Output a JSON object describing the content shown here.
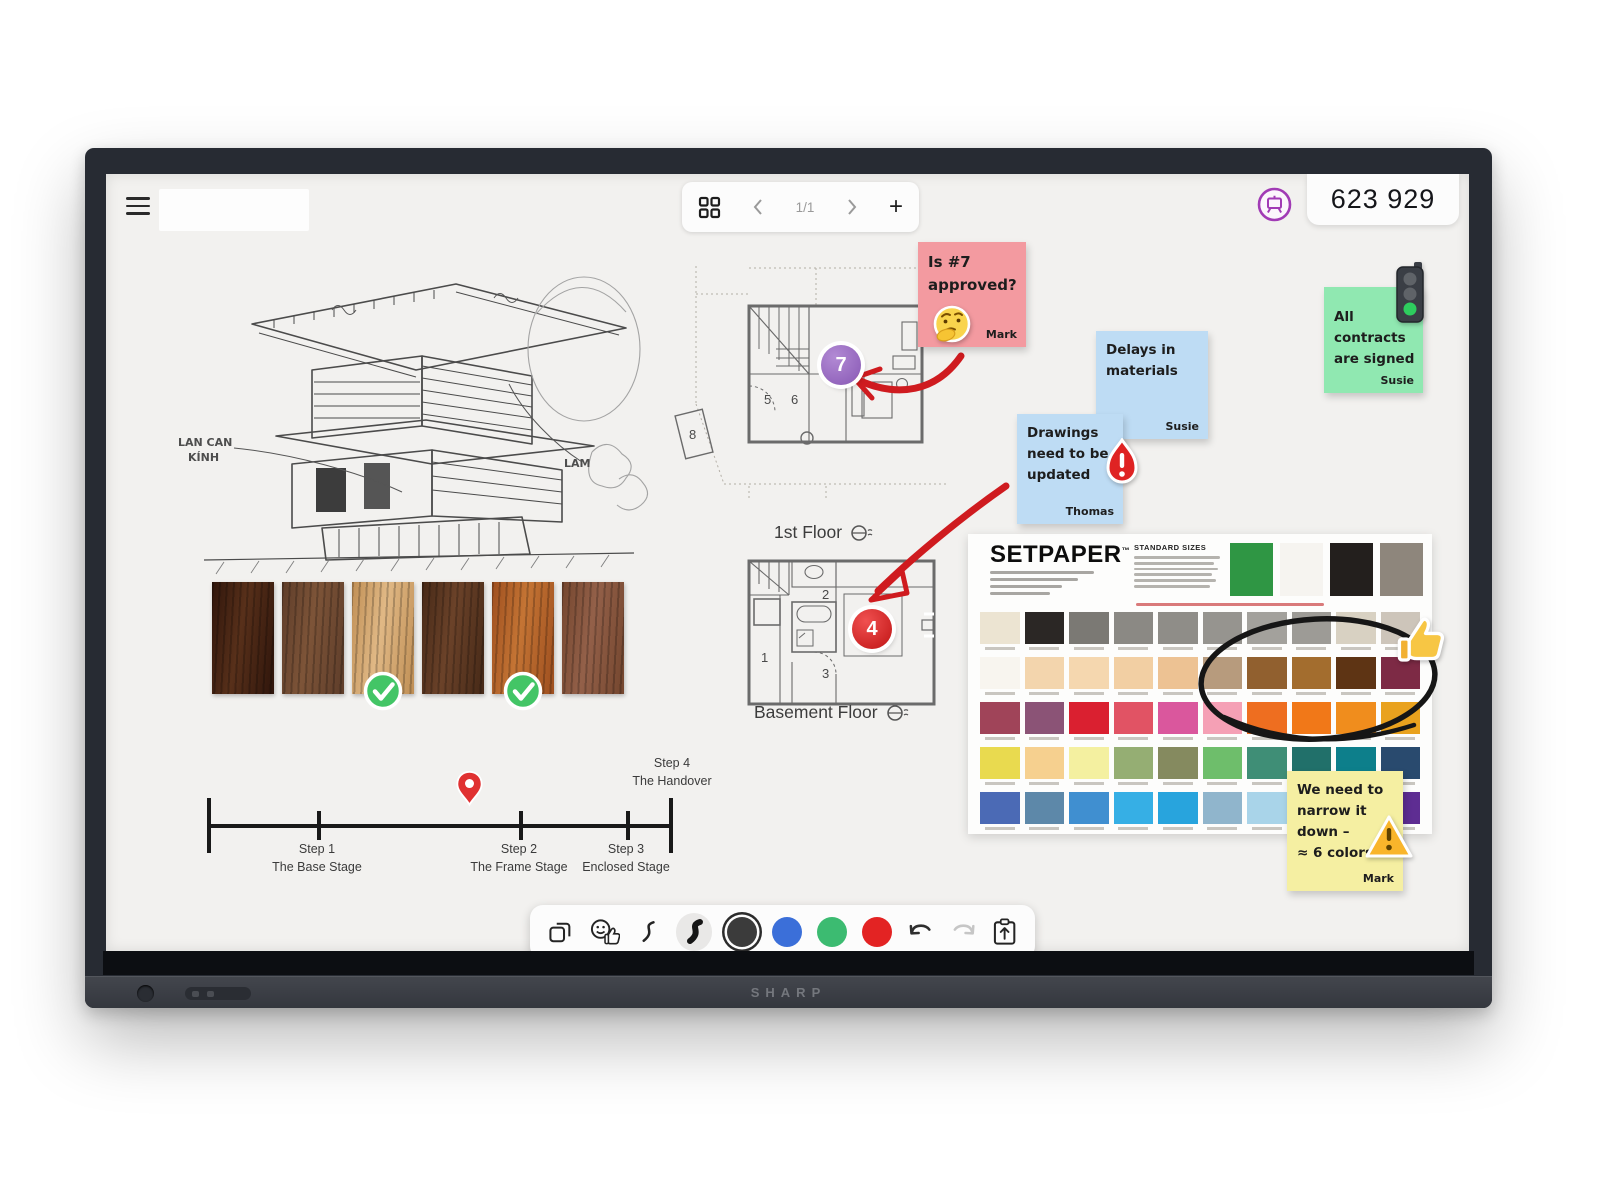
{
  "device": {
    "brand": "SHARP"
  },
  "topbar": {
    "page_indicator": "1/1",
    "session_code": "623 929"
  },
  "sketch": {
    "annotations": [
      "LAN CAN",
      "KÍNH",
      "LAM"
    ]
  },
  "plans": {
    "first_floor": {
      "label": "1st Floor",
      "rooms": [
        "5",
        "6",
        "8"
      ],
      "marker": "7",
      "marker_color": "#9b6ec4"
    },
    "basement": {
      "label": "Basement Floor",
      "rooms": [
        "1",
        "2",
        "3"
      ],
      "marker": "4",
      "marker_color": "#d81f26"
    }
  },
  "stickies": {
    "pink": {
      "lines": [
        "Is #7",
        "approved?"
      ],
      "author": "Mark",
      "color": "#f39aa0",
      "emoji": "thinking-face"
    },
    "delays": {
      "lines": [
        "Delays in",
        "materials"
      ],
      "author": "Susie",
      "color": "#bedcf4"
    },
    "drawings": {
      "lines": [
        "Drawings",
        "need to be",
        "updated"
      ],
      "author": "Thomas",
      "color": "#bedcf4",
      "emoji": "urgent-flame"
    },
    "contracts": {
      "lines": [
        "All",
        "contracts",
        "are signed"
      ],
      "author": "Susie",
      "color": "#90e8b1",
      "emoji": "green-traffic-light"
    },
    "narrow": {
      "lines": [
        "We need to",
        "narrow it",
        "down –",
        "≈ 6 colors"
      ],
      "author": "Mark",
      "color": "#f5efa2",
      "emoji": "warning-sign"
    }
  },
  "timeline": {
    "steps": [
      {
        "title": "Step 1",
        "subtitle": "The Base Stage"
      },
      {
        "title": "Step 2",
        "subtitle": "The Frame Stage"
      },
      {
        "title": "Step 3",
        "subtitle": "Enclosed Stage"
      },
      {
        "title": "Step 4",
        "subtitle": "The Handover"
      }
    ],
    "pin_color": "#e03131"
  },
  "wood": {
    "grains": [
      [
        "#2f150b",
        "#58301a"
      ],
      [
        "#5e3d2a",
        "#7d5438"
      ],
      [
        "#c08f55",
        "#e0b885"
      ],
      [
        "#462917",
        "#6b4229"
      ],
      [
        "#9e4f1f",
        "#c47434"
      ],
      [
        "#74462e",
        "#936049"
      ]
    ],
    "approved": [
      2,
      4
    ]
  },
  "paint_chart": {
    "brand": "SETPAPER",
    "tm": "™",
    "sizes_title": "STANDARD SIZES",
    "header_swatches": [
      "#2f9644",
      "#f6f4f0",
      "#231f1d",
      "#8e867c"
    ],
    "rows": [
      [
        "#ece4d2",
        "#2b2725",
        "#7b7974",
        "#8b8984",
        "#8f8d88",
        "#96948f",
        "#a3a19c",
        "#9d9b96",
        "#d8d1c2",
        "#cdc5ba"
      ],
      [
        "#f8f5ef",
        "#f3d5ad",
        "#f5d7af",
        "#f2cfa3",
        "#edc293",
        "#b79b7d",
        "#91602f",
        "#a36d2e",
        "#5e3414",
        "#7d2a45"
      ],
      [
        "#a04459",
        "#8b5376",
        "#da2030",
        "#e15364",
        "#da579d",
        "#f5a0b5",
        "#ee6e20",
        "#f17818",
        "#f08d1d",
        "#e9a21e"
      ],
      [
        "#e9da4f",
        "#f6d08f",
        "#f4f0a0",
        "#95ae73",
        "#858a5f",
        "#6ebe6b",
        "#3f8e76",
        "#21706a",
        "#0d7f8b",
        "#294a6e"
      ],
      [
        "#4b6ab5",
        "#5d88a9",
        "#408fd0",
        "#36afe5",
        "#28a4dd",
        "#90b5cc",
        "#a9d4e9",
        "#75b9d9",
        "#2b80a0",
        "#5e2d92"
      ]
    ],
    "circled_note": "hand-drawn circle around brown and orange swatches"
  },
  "toolbar": {
    "active_tool": "pen-bold",
    "colors": [
      {
        "name": "black",
        "hex": "#3b3b3b",
        "selected": true
      },
      {
        "name": "blue",
        "hex": "#3b6fd9",
        "selected": false
      },
      {
        "name": "green",
        "hex": "#3cbb71",
        "selected": false
      },
      {
        "name": "red",
        "hex": "#e32323",
        "selected": false
      }
    ]
  }
}
